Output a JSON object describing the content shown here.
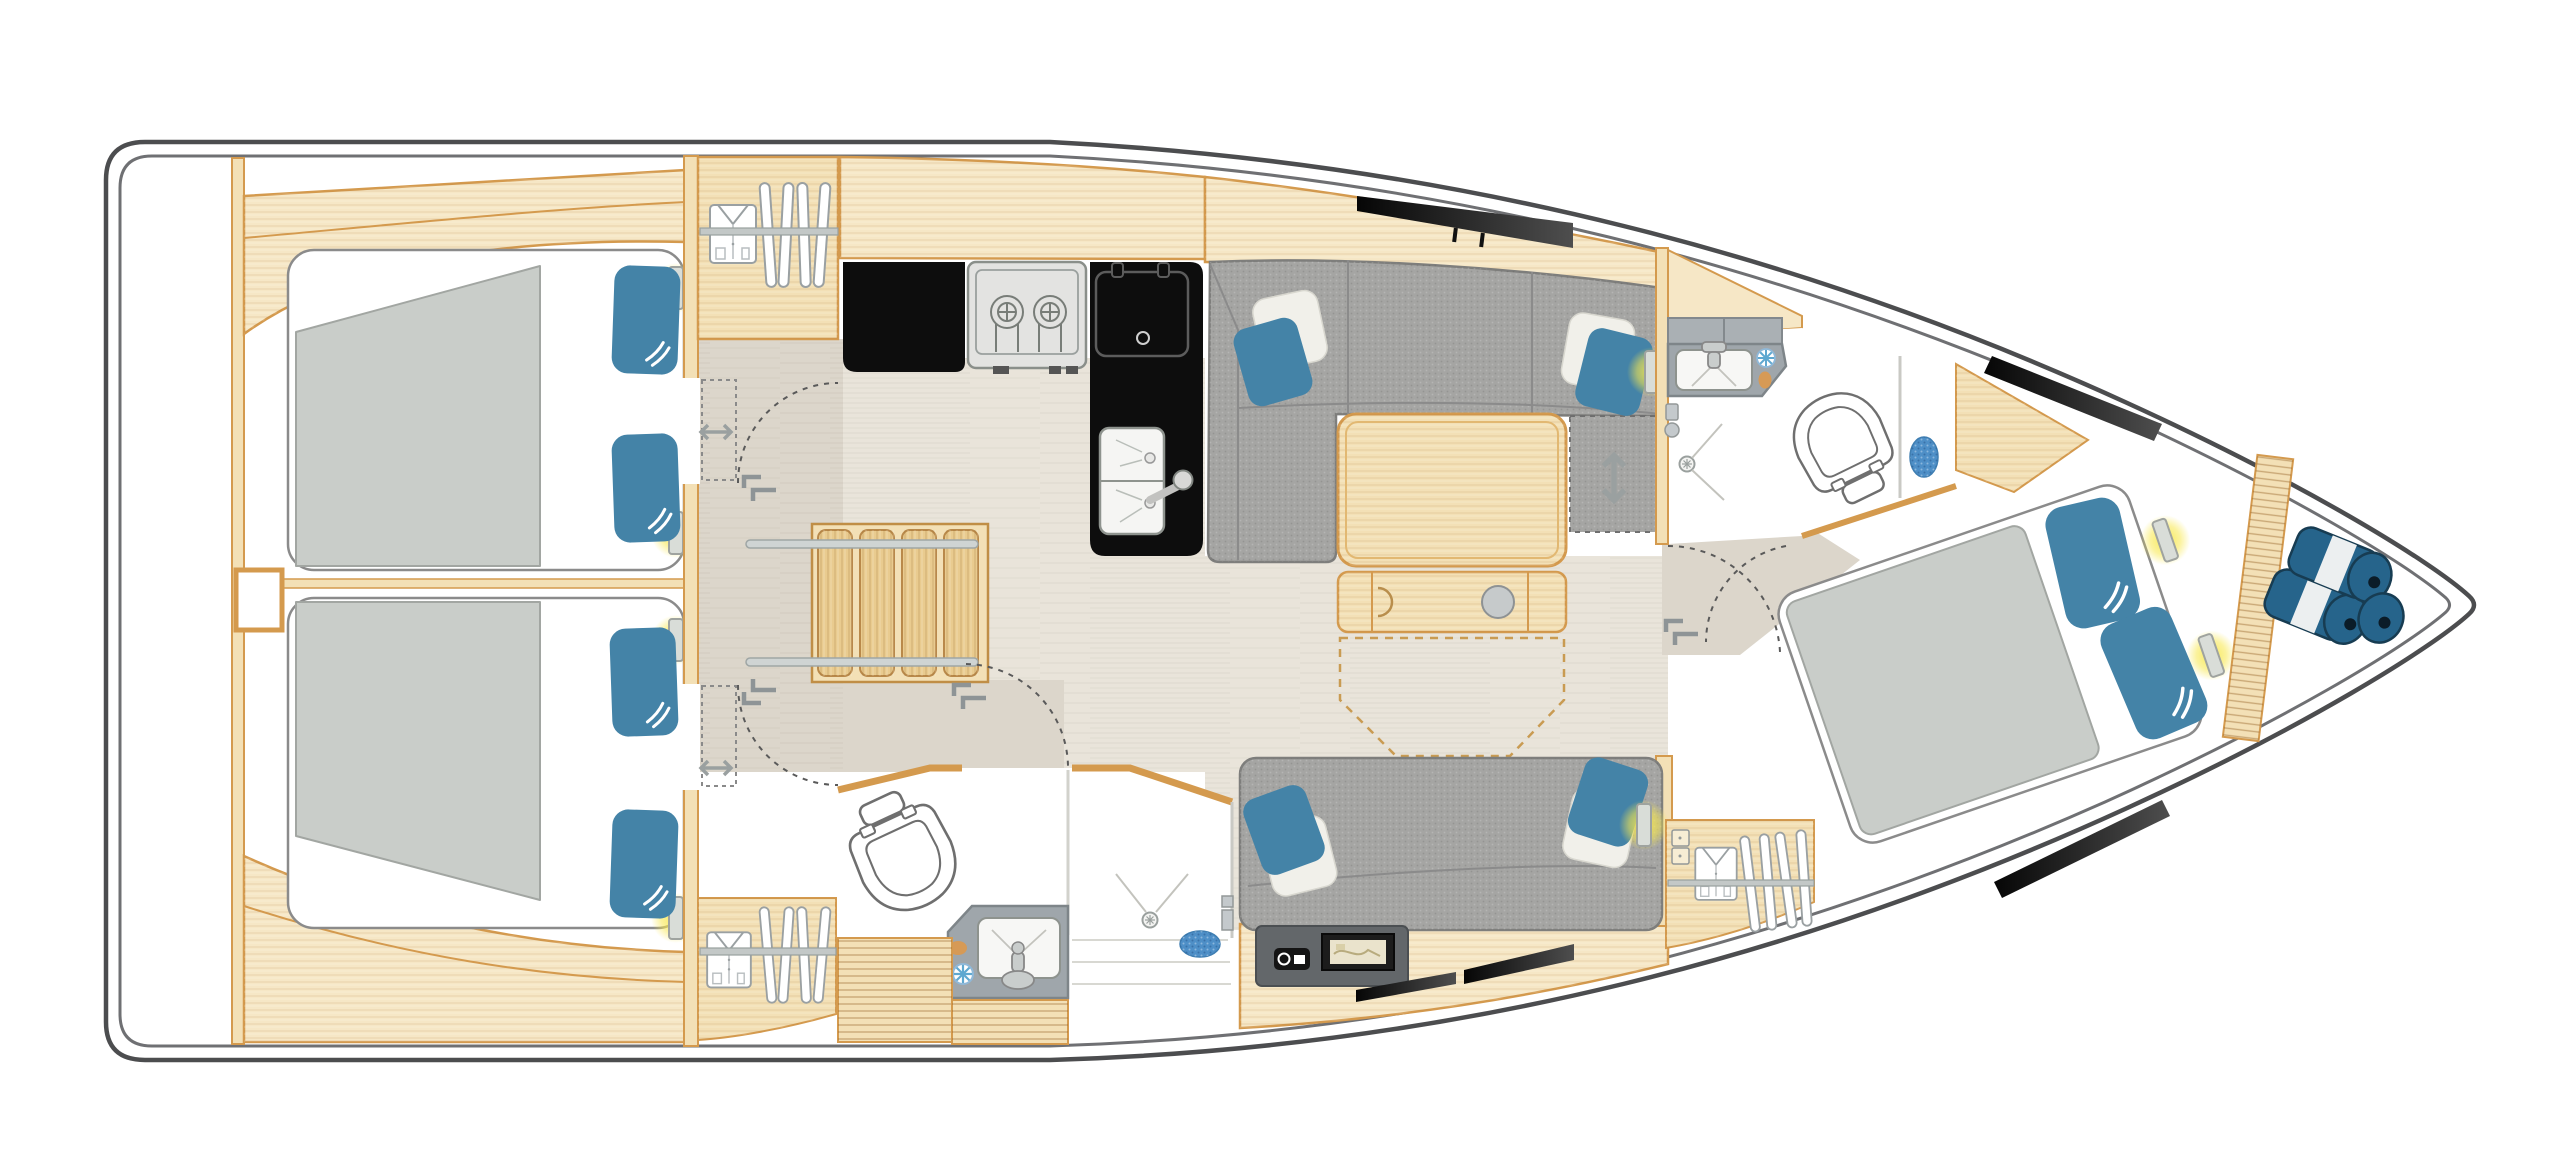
{
  "meta": {
    "content_type": "yacht-interior-floor-plan",
    "view": "top-down deck plan",
    "bow_direction": "right",
    "stern_direction": "left",
    "visible_text": ""
  },
  "colors": {
    "background": "#ffffff",
    "hull_outline": "#4c4d4f",
    "hull_inner_line": "#6f7073",
    "wood": "#f3e0b6",
    "wood_light": "#f6e7c6",
    "wood_stroke": "#d49a4e",
    "stair_wood": "#e9cb8f",
    "floor_light": "#e9e4da",
    "floor_corridor": "#dcd6cb",
    "sofa_gray": "#a5a5a3",
    "sofa_stroke": "#7e7e7c",
    "mattress_gray": "#c9cdc9",
    "bed_white": "#ffffff",
    "pillow_blue": "#4483a7",
    "pillow_white": "#f1f0ea",
    "counter_black": "#0d0d0d",
    "appliance_gray": "#e3e3e1",
    "bath_counter_gray": "#9fa6ab",
    "bath_locker_gray": "#aab0b4",
    "toilet_stroke": "#6f6f6f",
    "mat_blue": "#4e8fc7",
    "soap_orange": "#d69a56",
    "fender_blue": "#26648b",
    "fender_dark": "#173c52",
    "glow_yellow": "#f8e84e",
    "hardware_gray": "#8e9496",
    "rail_gray": "#cfd4d3",
    "dashed_line": "#5a5a5a",
    "table_dash": "#c99b52",
    "nav_panel": "#63676a"
  },
  "rooms": [
    {
      "key": "stern-lazarette",
      "label": "stern lazarette",
      "features": [
        "empty transom locker"
      ]
    },
    {
      "key": "aft-port-cabin",
      "label": "aft port cabin",
      "features": [
        "double berth",
        "gray mattress",
        "2 blue logo pillows",
        "2 reading lights",
        "sliding door",
        "side shelf"
      ]
    },
    {
      "key": "aft-starboard-cabin",
      "label": "aft starboard cabin",
      "features": [
        "double berth",
        "gray mattress",
        "2 blue logo pillows",
        "2 reading lights",
        "sliding door",
        "side shelf"
      ]
    },
    {
      "key": "companionway",
      "label": "companionway",
      "features": [
        "wooden stairs",
        "2 handrails",
        "corridor"
      ]
    },
    {
      "key": "galley",
      "label": "galley",
      "features": [
        "hanging locker with shirt and hangers",
        "black L-counter",
        "2-burner stove",
        "top-loading fridge",
        "double sink with mixer tap"
      ]
    },
    {
      "key": "salon",
      "label": "salon",
      "features": [
        "L-shaped gray sofa",
        "2 throw pillow sets",
        "folding wood table with cup holder",
        "convertible seat extension (dashed)",
        "deck hatch",
        "reading light"
      ]
    },
    {
      "key": "starboard-settee",
      "label": "starboard settee",
      "features": [
        "straight gray sofa",
        "2 throw pillow sets",
        "reading light",
        "nav instrument panel",
        "chart plotter",
        "radio",
        "hull window strips"
      ]
    },
    {
      "key": "aft-head",
      "label": "aft head",
      "features": [
        "toilet",
        "vanity sink",
        "shower with drain",
        "blue bath mat",
        "vent fan",
        "soap dish",
        "door swing arc"
      ]
    },
    {
      "key": "forward-head",
      "label": "forward head",
      "features": [
        "toilet",
        "vanity sink",
        "gray lockers",
        "shower with drain",
        "blue bath mat",
        "vent fan",
        "soap dish",
        "door swing arcs"
      ]
    },
    {
      "key": "forward-cabin",
      "label": "forward owner cabin",
      "features": [
        "angled island double berth",
        "2 blue logo pillows",
        "2 reading lights",
        "wardrobe with shirt and hangers",
        "2 black hull windows",
        "entry step"
      ]
    },
    {
      "key": "bow-locker",
      "label": "bow locker",
      "features": [
        "slatted bulkhead",
        "3 blue fenders"
      ]
    }
  ],
  "icons": {
    "shirt-icon": "folded shirt in hanging locker",
    "hanger-icon": "clothes hanger on rail",
    "reading-light-icon": "wall reading light with yellow glow",
    "slide-arrow-icon": "double-headed sliding-door arrow",
    "convert-arrow-icon": "up-down convertible-seat arrow",
    "door-arc": "dashed door swing arc",
    "door-handle-icon": "door pull brackets",
    "burner-icon": "gas stove burner",
    "sink-icon": "sink basin with tap",
    "drain-icon": "shower drain rose",
    "vent-fan-icon": "blue vent fan",
    "soap-icon": "soap dish",
    "bath-mat-icon": "blue bath mat",
    "fender-icon": "blue boat fender roll",
    "hatch-icon": "black deck hatch / hull window",
    "cup-holder-icon": "table cup holder",
    "chart-plotter-icon": "chart plotter screen",
    "radio-icon": "marine radio"
  },
  "counts": {
    "cabins": 3,
    "heads": 2,
    "blue_pillows": 10,
    "white_pillows": 4,
    "reading_lights": 8,
    "fenders": 3,
    "stove_burners": 2,
    "toilets": 2,
    "showers": 2,
    "wardrobes": 3,
    "deck_hatches": 1,
    "hull_window_strips": 4
  }
}
